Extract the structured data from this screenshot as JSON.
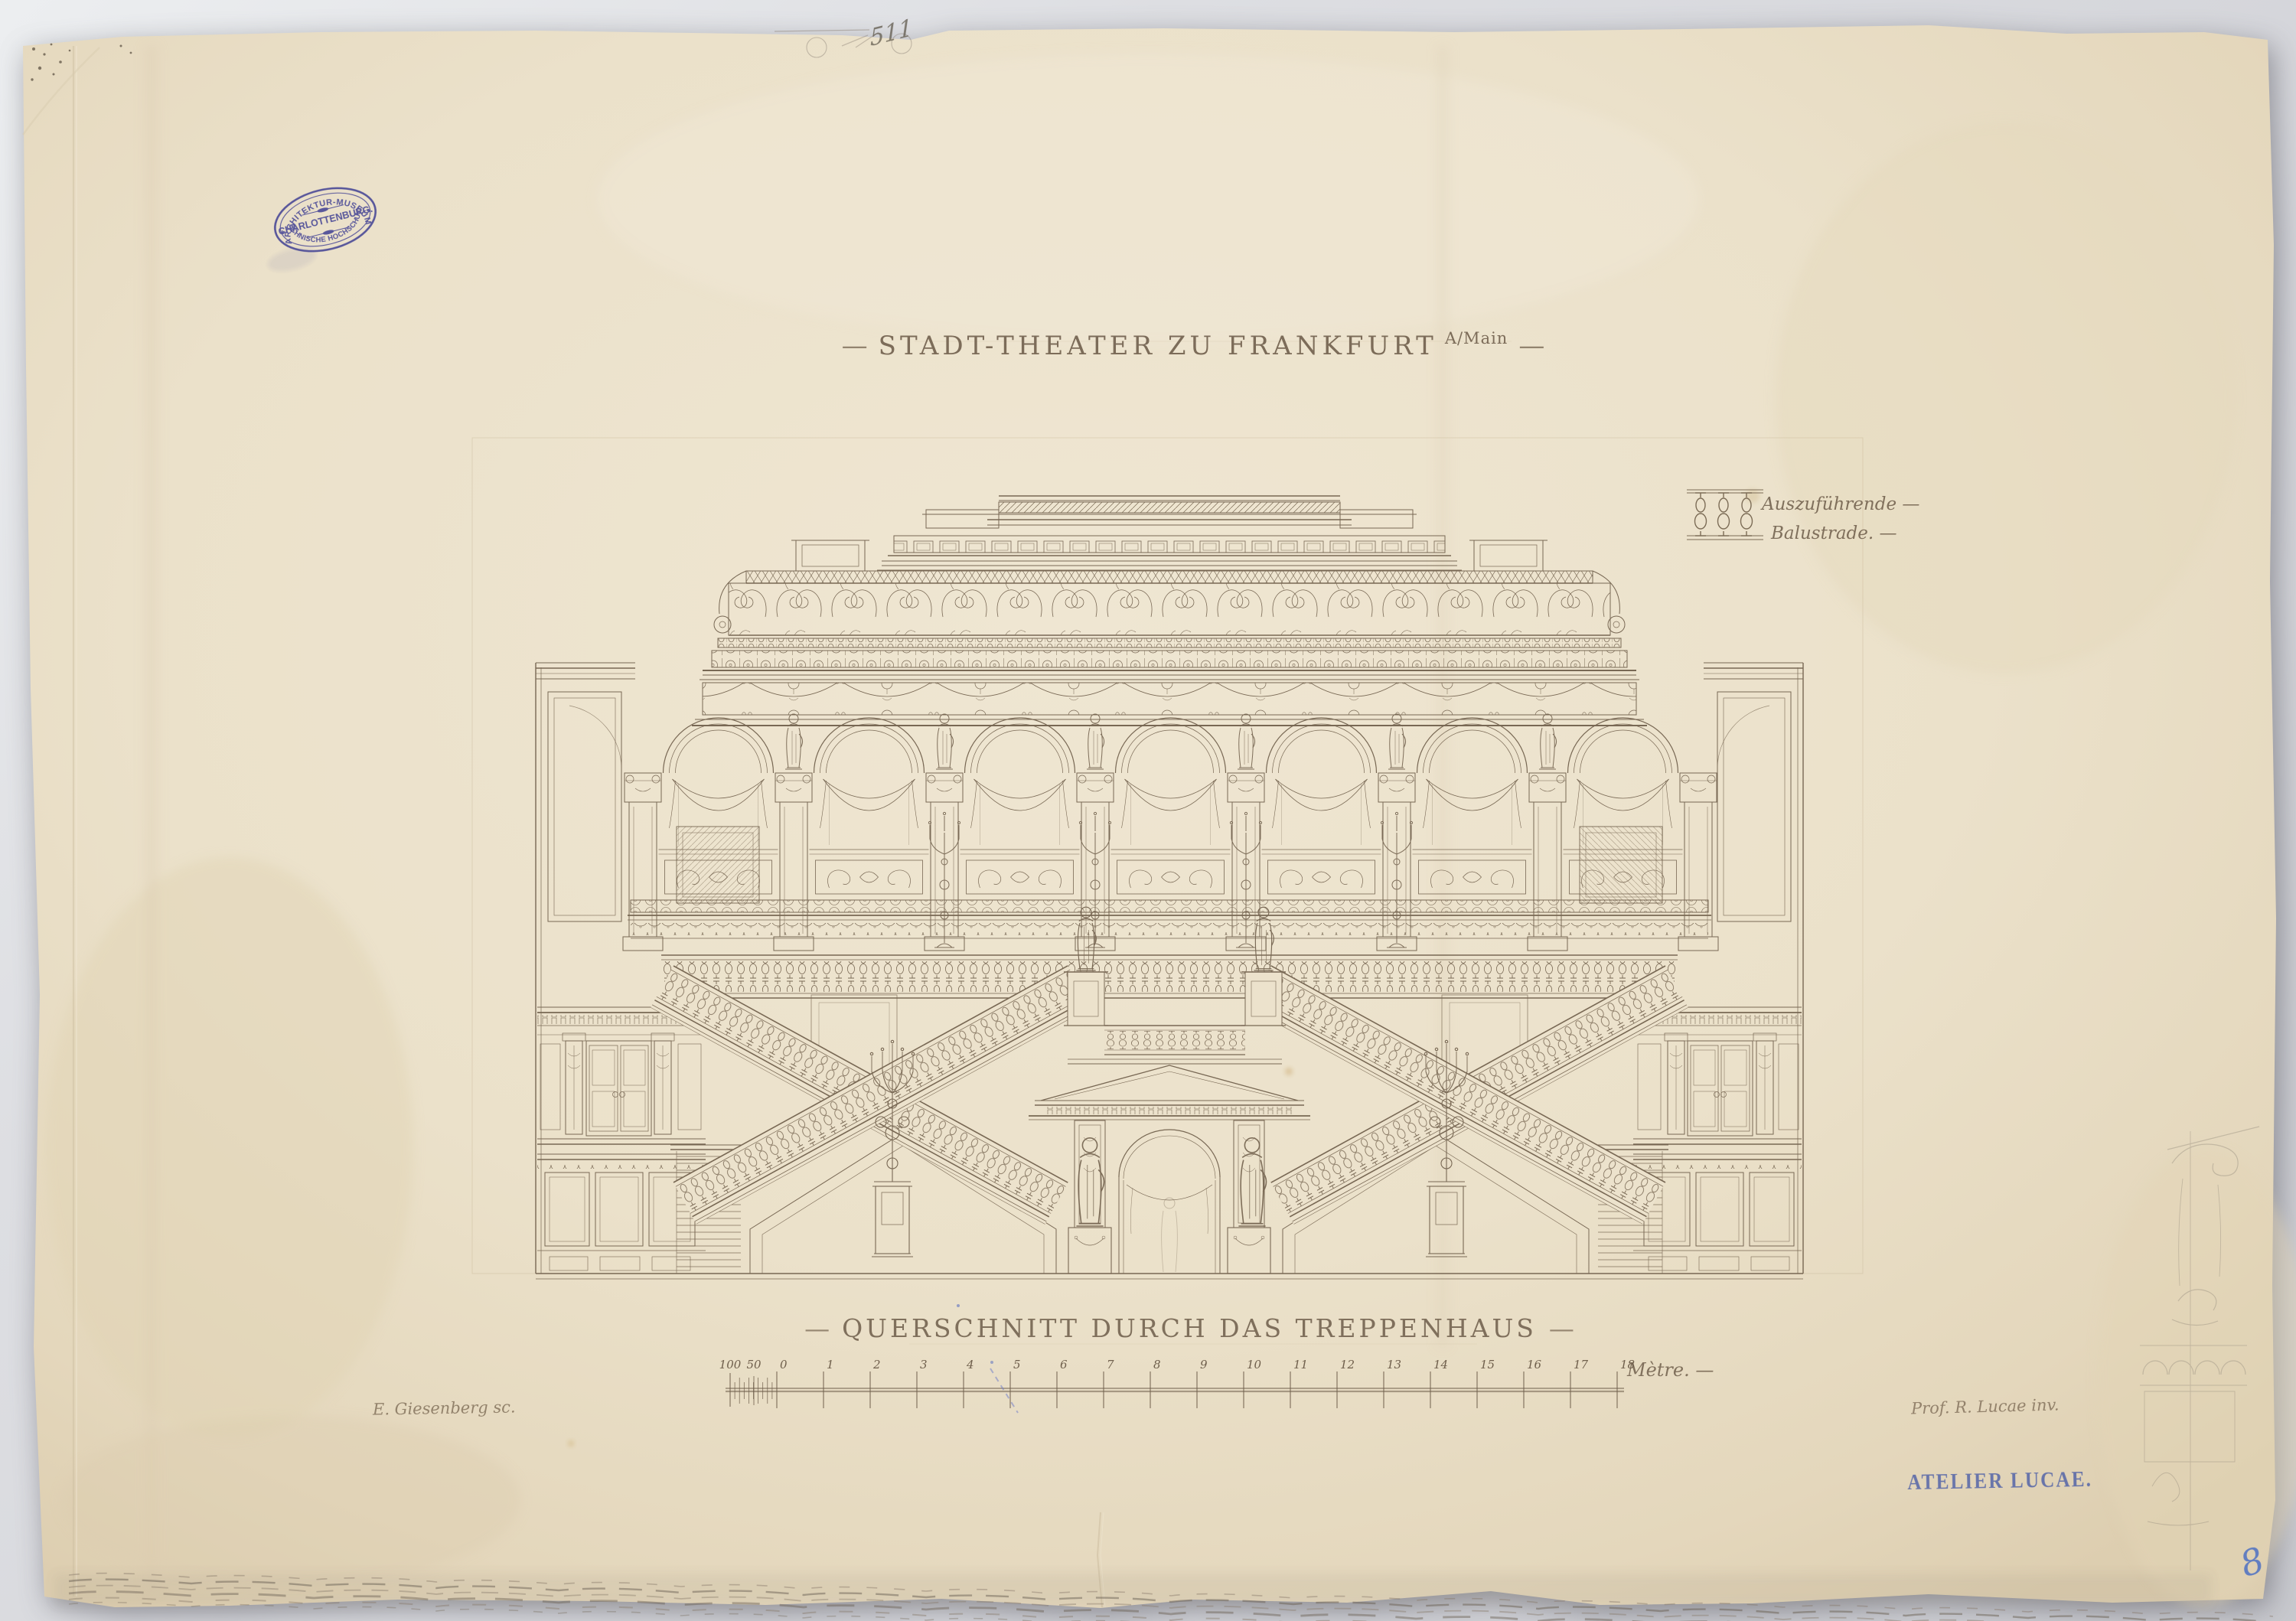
{
  "document": {
    "title": {
      "dash_left": "—",
      "text": "STADT-THEATER ZU FRANKFURT",
      "suffix": "A/Main",
      "dash_right": "—"
    },
    "caption": {
      "dash_left": "—",
      "text": "QUERSCHNITT DURCH DAS TREPPENHAUS",
      "dash_right": "—"
    },
    "legend": {
      "line1": "Auszuführende —",
      "line2": "Balustrade. —"
    },
    "scalebar": {
      "labels": [
        "100",
        "50",
        "0",
        "1",
        "2",
        "3",
        "4",
        "5",
        "6",
        "7",
        "8",
        "9",
        "10",
        "11",
        "12",
        "13",
        "14",
        "15",
        "16",
        "17",
        "18"
      ],
      "unit_label": "Mètre. —"
    },
    "signatures": {
      "engraver": "E. Giesenberg sc.",
      "architect": "Prof. R. Lucae inv."
    },
    "museum_stamp": {
      "arc_top": "ARCHITEKTUR-MUSEUM",
      "center": "CHARLOTTENBURG.",
      "arc_bottom": "TECHNISCHE HOCHSCHULE.",
      "star_left": "*",
      "star_right": "*"
    },
    "atelier_stamp": "ATELIER LUCAE.",
    "pencil_note": "511",
    "page_number": "8"
  },
  "colors": {
    "paper": "#ece2cc",
    "ink": "#6e5d49",
    "pencil": "#8d8478",
    "stamp_blue": "#3c3c92",
    "atelier_blue": "#4c5ea8",
    "page_number_blue": "#3f66c0",
    "background": "#d8d8dc"
  }
}
